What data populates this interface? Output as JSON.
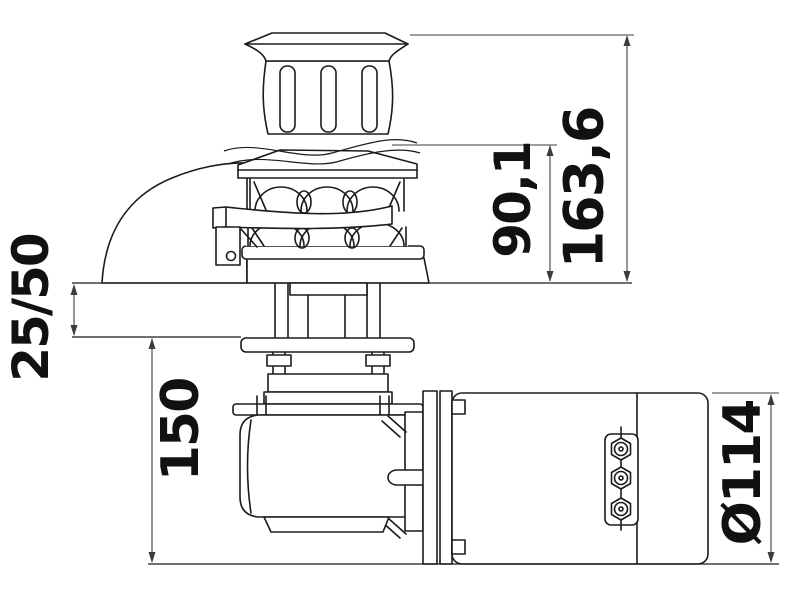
{
  "drawing": {
    "subject": "vertical-windlass-side-elevation",
    "background_color": "#ffffff",
    "line_color": "#1b1b1b",
    "dimension_line_color": "#3c3c3c",
    "text_color": "#111111",
    "dimensions": {
      "overall_height": "163,6",
      "gypsy_height": "90,1",
      "deck_thickness": "25/50",
      "below_deck_depth": "150",
      "motor_diameter": "Ø114"
    }
  }
}
